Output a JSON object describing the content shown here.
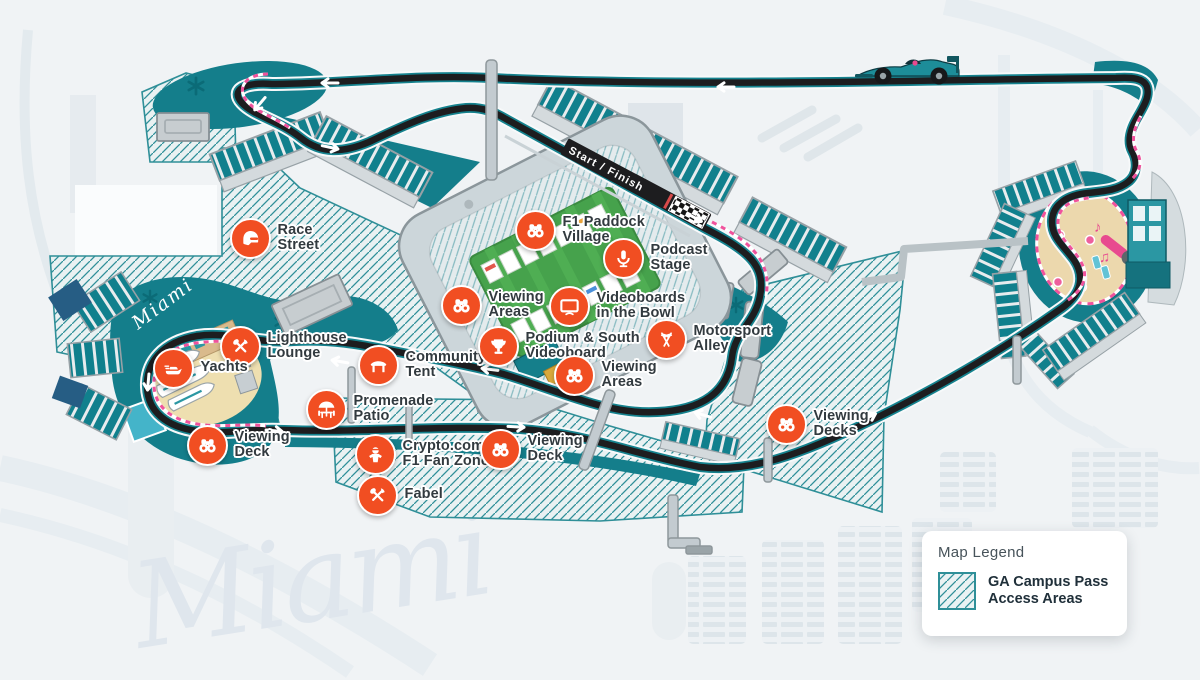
{
  "watermarks": {
    "big": "Miami",
    "marina": "Miami"
  },
  "track": {
    "start_finish_label": "Start / Finish"
  },
  "legend": {
    "title": "Map Legend",
    "item_label": "GA Campus Pass\nAccess Areas",
    "swatch": "ga-hatch-swatch"
  },
  "colors": {
    "poi_orange": "#f14e22",
    "track_teal": "#15828e",
    "hatch_teal": "#2f8f98",
    "landscape_teal": "#147e8b"
  },
  "pois": [
    {
      "id": "race-street",
      "icon": "helmet-icon",
      "label": "Race\nStreet",
      "x": 248,
      "y": 236
    },
    {
      "id": "f1-paddock-village",
      "icon": "binoculars-icon",
      "label": "F1 Paddock\nVillage",
      "x": 533,
      "y": 228
    },
    {
      "id": "podcast-stage",
      "icon": "microphone-icon",
      "label": "Podcast\nStage",
      "x": 621,
      "y": 256
    },
    {
      "id": "viewing-areas-west",
      "icon": "binoculars-icon",
      "label": "Viewing\nAreas",
      "x": 459,
      "y": 303
    },
    {
      "id": "videoboards-in-the-bowl",
      "icon": "videoboard-icon",
      "label": "Videoboards\nin the Bowl",
      "x": 567,
      "y": 304
    },
    {
      "id": "motorsport-alley",
      "icon": "flags-icon",
      "label": "Motorsport\nAlley",
      "x": 664,
      "y": 337
    },
    {
      "id": "lighthouse-lounge",
      "icon": "utensils-icon",
      "label": "Lighthouse\nLounge",
      "x": 238,
      "y": 344
    },
    {
      "id": "yachts",
      "icon": "yacht-icon",
      "label": "Yachts",
      "x": 171,
      "y": 366
    },
    {
      "id": "community-tent",
      "icon": "tent-icon",
      "label": "Community\nTent",
      "x": 376,
      "y": 363
    },
    {
      "id": "podium-south-videoboard",
      "icon": "trophy-icon",
      "label": "Podium & South\nVideoboard",
      "x": 496,
      "y": 344
    },
    {
      "id": "viewing-areas-south",
      "icon": "binoculars-icon",
      "label": "Viewing\nAreas",
      "x": 572,
      "y": 373
    },
    {
      "id": "promenade-patio",
      "icon": "patio-icon",
      "label": "Promenade\nPatio",
      "x": 324,
      "y": 407
    },
    {
      "id": "viewing-deck-marina",
      "icon": "binoculars-icon",
      "label": "Viewing\nDeck",
      "x": 205,
      "y": 443
    },
    {
      "id": "crypto-f1-fan-zone",
      "icon": "fan-icon",
      "label": "Crypto.com\nF1 Fan Zone",
      "x": 373,
      "y": 452
    },
    {
      "id": "viewing-deck-south",
      "icon": "binoculars-icon",
      "label": "Viewing\nDeck",
      "x": 498,
      "y": 447
    },
    {
      "id": "fabel",
      "icon": "utensils-icon",
      "label": "Fabel",
      "x": 375,
      "y": 493
    },
    {
      "id": "viewing-decks-east",
      "icon": "binoculars-icon",
      "label": "Viewing\nDecks",
      "x": 784,
      "y": 422
    }
  ]
}
